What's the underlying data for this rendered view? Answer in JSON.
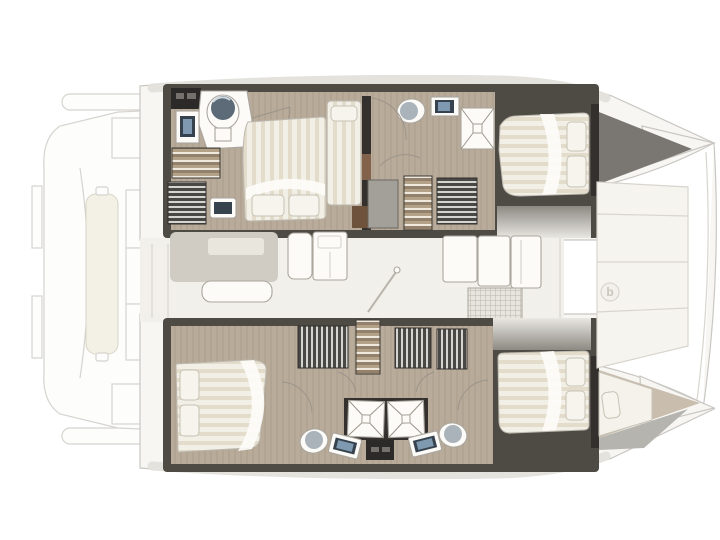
{
  "drawing": {
    "kind": "catamaran-interior-floorplan",
    "orientation": "bow-right"
  },
  "logo": {
    "glyph": "b"
  },
  "areas": {
    "stern_platform": "stern-platform",
    "salon": "salon",
    "hull_top": "hull-top",
    "hull_bottom": "hull-bottom",
    "foredeck": "foredeck",
    "bow_locker": "bow-locker",
    "bow_berth": "bow-berth"
  },
  "inventory": {
    "double_beds": 4,
    "single_berths": 2,
    "toilets": 4,
    "sinks": 5,
    "showers": 3,
    "wardrobes": 5,
    "staircases": 3,
    "dining_tables": 1,
    "bench_seats": 1,
    "galley_units": 2,
    "sunpads": 1
  },
  "palette": {
    "background": "#ffffff",
    "outline": "#c9c7c2",
    "ghost_line": "#d6d4cf",
    "ghost_fill": "#fdfdfc",
    "deck": "#f7f6f3",
    "deck_shade": "#e4e2dd",
    "hull_shade": "#b6b4af",
    "bow_locker": "#7a7772",
    "wall": "#4e4a44",
    "wall_dark": "#33302d",
    "floor": "#b8ab9a",
    "floor_light": "#c9bdae",
    "salon_floor": "#f2f0ea",
    "white_fixture": "#fcfbf8",
    "fixture_line": "#aaa69e",
    "table": "#d0ccc3",
    "table_inset": "#e9e6dd",
    "bed": "#f2efe7",
    "bed_stripe": "#e3dccb",
    "pillow": "#f6f4ec",
    "pillow_line": "#c6c2b5",
    "toilet_lid_dark": "#5d6b78",
    "toilet_lid_light": "#aab3ba",
    "basin": "#36434f",
    "basin_screen": "#7f9ab0",
    "wood": "#82624a",
    "arc": "#9b948a",
    "panel_seam": "#d8d5cd",
    "foredeck": "#f6f4ef",
    "logo_color": "#c9c6be"
  }
}
